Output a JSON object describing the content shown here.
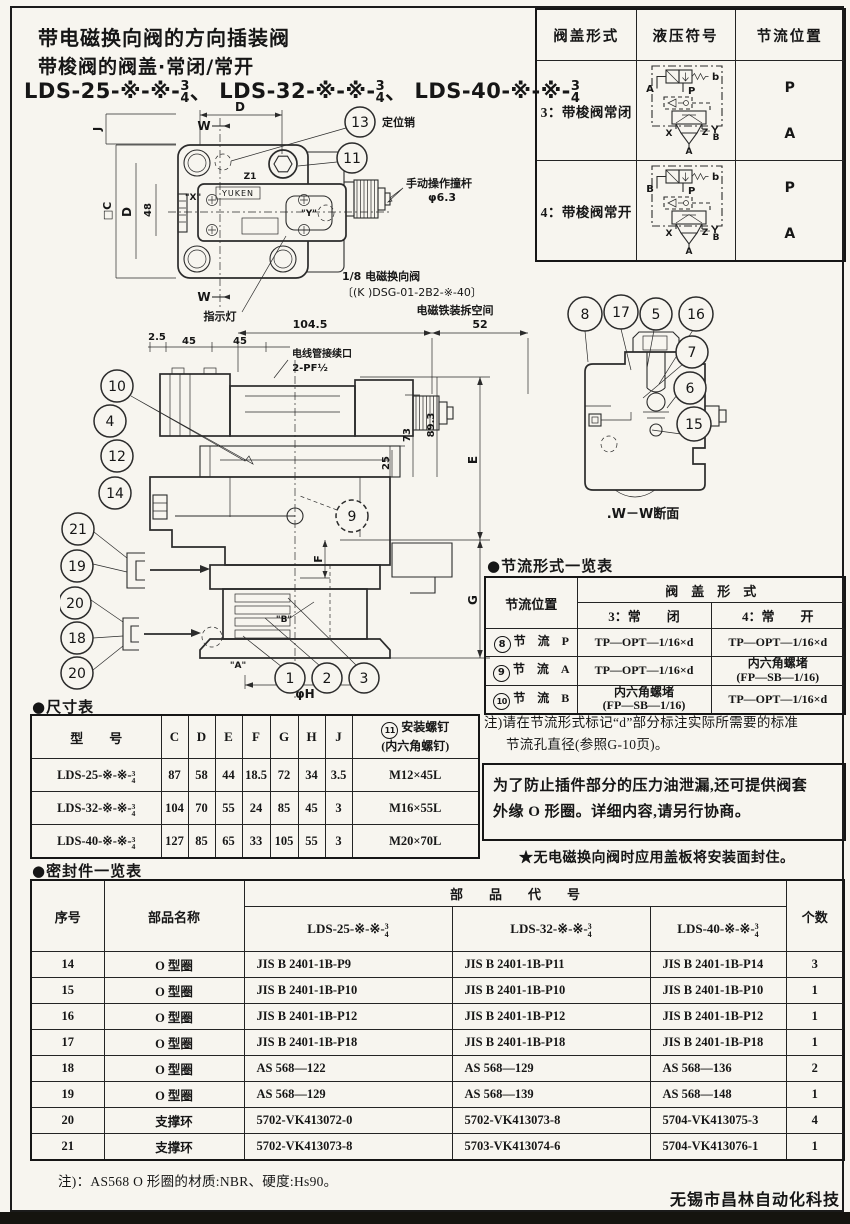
{
  "doc": {
    "title1": "带电磁换向阀的方向插装阀",
    "title2": "带梭阀的阀盖·常闭/常开",
    "models": [
      {
        "prefix": "LDS-25-※-※-",
        "num": "3",
        "den": "4",
        "sep": "、"
      },
      {
        "prefix": "LDS-32-※-※-",
        "num": "3",
        "den": "4",
        "sep": "、"
      },
      {
        "prefix": "LDS-40-※-※-",
        "num": "3",
        "den": "4",
        "sep": ""
      }
    ],
    "footer": "无锡市昌林自动化科技"
  },
  "cover_table": {
    "headers": [
      "阀盖形式",
      "液压符号",
      "节流位置"
    ],
    "rows": [
      {
        "label": "3：带梭阀常闭",
        "pos_top": "P",
        "pos_bottom": "A",
        "sym": {
          "left": "A",
          "p": "P",
          "b": "b",
          "x": "X",
          "z": "Z",
          "y": "Y",
          "b2": "B",
          "a": "A"
        }
      },
      {
        "label": "4：带梭阀常开",
        "pos_top": "P",
        "pos_bottom": "A",
        "sym": {
          "left": "B",
          "p": "P",
          "b": "b",
          "x": "X",
          "z": "Z",
          "y": "Y",
          "b2": "B",
          "a": "A"
        }
      }
    ]
  },
  "plan": {
    "callout_13": "13",
    "callout_11": "11",
    "pin_label": "定位销",
    "rod_label1": "手动操作撞杆",
    "rod_label2": "φ6.3",
    "valve_label1": "1/8 电磁换向阀",
    "valve_label2": "〔(K )DSG-01-2B2-※-40〕",
    "indicator_label": "指示灯",
    "brand": "YUKEN",
    "dim_d_top": "D",
    "dim_j": "J",
    "dim_c": "□C",
    "dim_d_left": "D",
    "dim_48": "48",
    "w_top": "W",
    "w_bottom": "W",
    "port_x": "\"X\"",
    "port_y": "\"Y\"",
    "port_z": "Z1"
  },
  "section": {
    "space_label": "电磁铁装拆空间",
    "dim_52": "52",
    "dim_1045": "104.5",
    "dim_25": "2.5",
    "dim_45a": "45",
    "dim_45b": "45",
    "conduit1": "电线管接续口",
    "conduit2": "2-PF½",
    "dim_73": "73",
    "dim_893": "89.3",
    "dim_25r": "25",
    "dim_E": "E",
    "dim_F": "F",
    "dim_G": "G",
    "phi_h": "φH",
    "label_a": "\"A\"",
    "label_b": "\"B\"",
    "callouts_top": [
      "10",
      "4",
      "12",
      "14"
    ],
    "callouts_bottom": [
      "21",
      "19",
      "20",
      "18",
      "20"
    ],
    "callout_9": "9",
    "callouts_parts": [
      "1",
      "2",
      "3"
    ]
  },
  "ww": {
    "callouts": [
      "8",
      "17",
      "5",
      "16",
      "7",
      "6",
      "15"
    ],
    "caption": ".W－W断面"
  },
  "throttle_table": {
    "label": "●节流形式一览表",
    "pos_header": "节流位置",
    "span_header": "阀　盖　形　式",
    "sub1": "3：常　　闭",
    "sub2": "4：常　　开",
    "rows": [
      {
        "circ": "8",
        "pos": "节　流　P",
        "c1a": "TP—OPT—1/16×d",
        "c1b": "",
        "c2a": "TP—OPT—1/16×d",
        "c2b": ""
      },
      {
        "circ": "9",
        "pos": "节　流　A",
        "c1a": "TP—OPT—1/16×d",
        "c1b": "",
        "c2a": "内六角螺堵",
        "c2b": "(FP—SB—1/16)"
      },
      {
        "circ": "10",
        "pos": "节　流　B",
        "c1a": "内六角螺堵",
        "c1b": "(FP—SB—1/16)",
        "c2a": "TP—OPT—1/16×d",
        "c2b": ""
      }
    ],
    "note1": "注)请在节流形式标记“d”部分标注实际所需要的标准",
    "note2": "节流孔直径(参照G-10页)。"
  },
  "notes": {
    "boxed1": "为了防止插件部分的压力油泄漏,还可提供阀套",
    "boxed2": "外缘 O 形圈。详细内容,请另行协商。",
    "star": "★无电磁换向阀时应用盖板将安装面封住。",
    "seal_note": "注)：AS568 O 形圈的材质:NBR、硬度:Hs90。"
  },
  "dim_table": {
    "label": "●尺寸表",
    "model_header": "型　　号",
    "cols": [
      "C",
      "D",
      "E",
      "F",
      "G",
      "H",
      "J"
    ],
    "screw_circ": "11",
    "screw_header1": "安装螺钉",
    "screw_header2": "(内六角螺钉)",
    "rows": [
      {
        "prefix": "LDS-25-※-※-",
        "num": "3",
        "den": "4",
        "vals": [
          "87",
          "58",
          "44",
          "18.5",
          "72",
          "34",
          "3.5"
        ],
        "screw": "M12×45L"
      },
      {
        "prefix": "LDS-32-※-※-",
        "num": "3",
        "den": "4",
        "vals": [
          "104",
          "70",
          "55",
          "24",
          "85",
          "45",
          "3"
        ],
        "screw": "M16×55L"
      },
      {
        "prefix": "LDS-40-※-※-",
        "num": "3",
        "den": "4",
        "vals": [
          "127",
          "85",
          "65",
          "33",
          "105",
          "55",
          "3"
        ],
        "screw": "M20×70L"
      }
    ]
  },
  "seal_table": {
    "label": "●密封件一览表",
    "h_no": "序号",
    "h_name": "部品名称",
    "h_code": "部　　品　　代　　号",
    "h_qty": "个数",
    "models": [
      {
        "prefix": "LDS-25-※-※-",
        "num": "3",
        "den": "4"
      },
      {
        "prefix": "LDS-32-※-※-",
        "num": "3",
        "den": "4"
      },
      {
        "prefix": "LDS-40-※-※-",
        "num": "3",
        "den": "4"
      }
    ],
    "rows": [
      {
        "no": "14",
        "name": "O 型圈",
        "c1": "JIS B 2401-1B-P9",
        "c2": "JIS B 2401-1B-P11",
        "c3": "JIS B 2401-1B-P14",
        "qty": "3"
      },
      {
        "no": "15",
        "name": "O 型圈",
        "c1": "JIS B 2401-1B-P10",
        "c2": "JIS B 2401-1B-P10",
        "c3": "JIS B 2401-1B-P10",
        "qty": "1"
      },
      {
        "no": "16",
        "name": "O 型圈",
        "c1": "JIS B 2401-1B-P12",
        "c2": "JIS B 2401-1B-P12",
        "c3": "JIS B 2401-1B-P12",
        "qty": "1"
      },
      {
        "no": "17",
        "name": "O 型圈",
        "c1": "JIS B 2401-1B-P18",
        "c2": "JIS B 2401-1B-P18",
        "c3": "JIS B 2401-1B-P18",
        "qty": "1"
      },
      {
        "no": "18",
        "name": "O 型圈",
        "c1": "AS 568—122",
        "c2": "AS 568—129",
        "c3": "AS 568—136",
        "qty": "2"
      },
      {
        "no": "19",
        "name": "O 型圈",
        "c1": "AS 568—129",
        "c2": "AS 568—139",
        "c3": "AS 568—148",
        "qty": "1"
      },
      {
        "no": "20",
        "name": "支撑环",
        "c1": "5702-VK413072-0",
        "c2": "5702-VK413073-8",
        "c3": "5704-VK413075-3",
        "qty": "4"
      },
      {
        "no": "21",
        "name": "支撑环",
        "c1": "5702-VK413073-8",
        "c2": "5703-VK413074-6",
        "c3": "5704-VK413076-1",
        "qty": "1"
      }
    ]
  }
}
